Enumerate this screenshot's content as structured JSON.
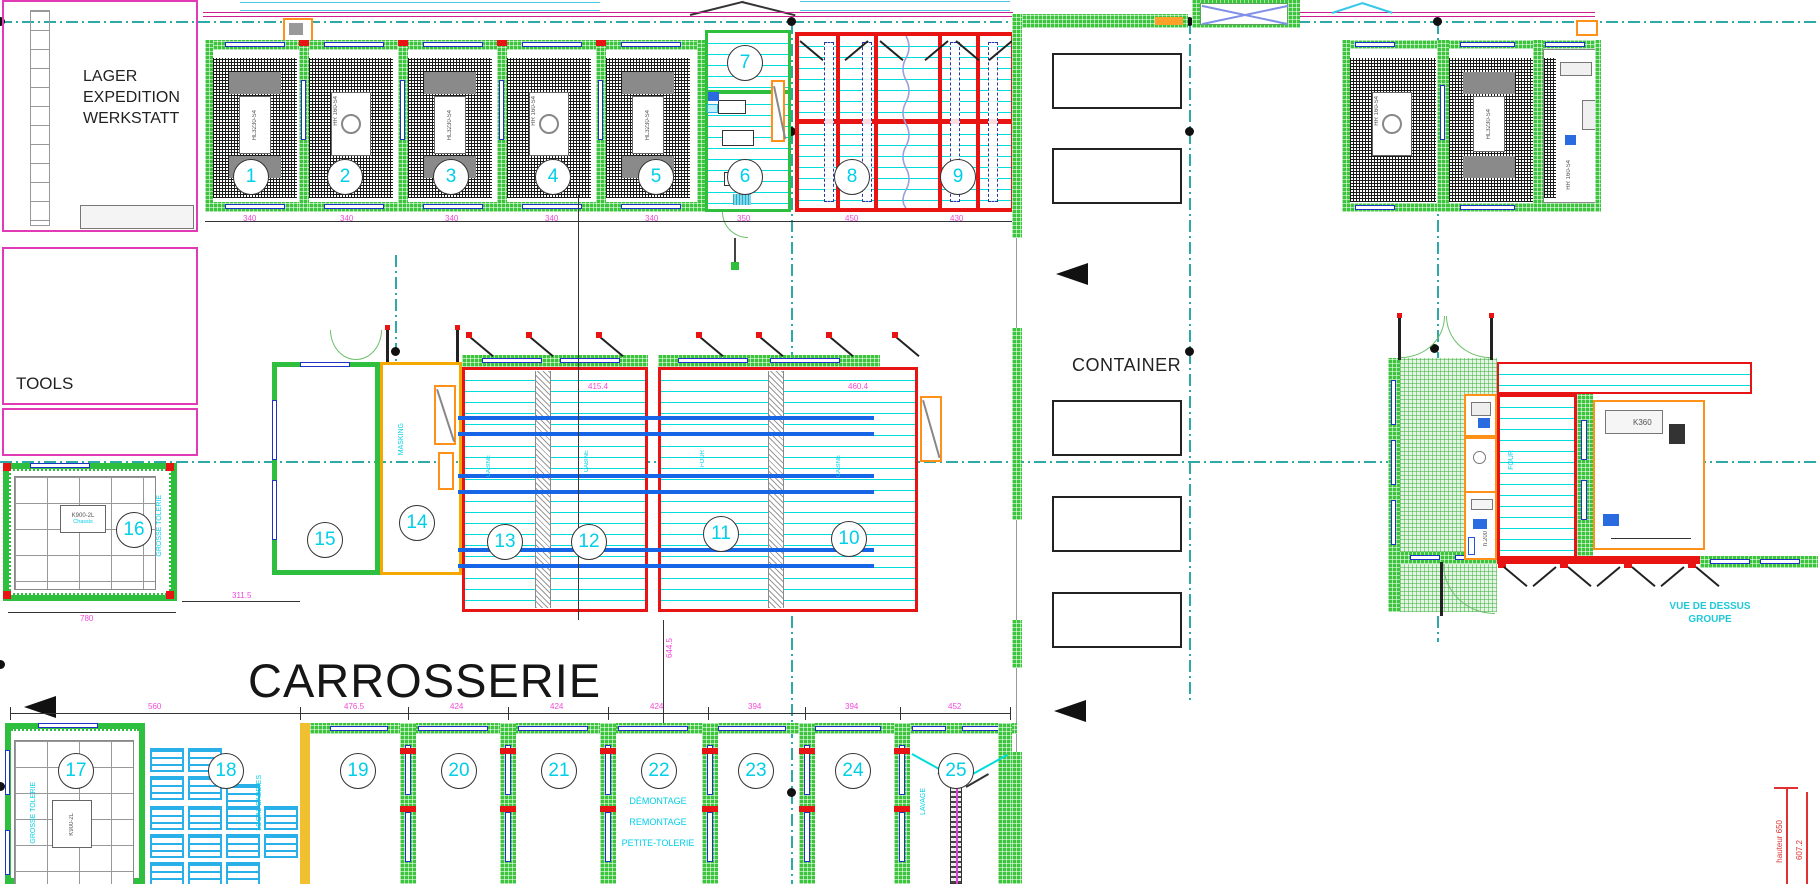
{
  "colors": {
    "green_wall": "#3cc43c",
    "red_wall": "#e81414",
    "cyan_line": "#00dcdc",
    "cyan_text": "#00cfe8",
    "magenta_dim": "#f049d8",
    "blue_rail": "#1565e6",
    "window_blue": "#1f32c8",
    "orange": "#ff9018",
    "grid_teal": "#2fa8a8"
  },
  "areas": {
    "lager": [
      "LAGER",
      "EXPEDITION",
      "WERKSTATT"
    ],
    "tools": "TOOLS",
    "carrosserie": "CARROSSERIE",
    "container": "CONTAINER"
  },
  "stations": [
    "1",
    "2",
    "3",
    "4",
    "5",
    "6",
    "7",
    "8",
    "9",
    "10",
    "11",
    "12",
    "13",
    "14",
    "15",
    "16",
    "17",
    "18",
    "19",
    "20",
    "21",
    "22",
    "23",
    "24",
    "25"
  ],
  "zone_labels": {
    "masking": "MASKING",
    "grosse_tolerie_16": "GROSSE TOLERIE",
    "grosse_tolerie_17": "GROSSE TOLERIE",
    "local_caddies": "LOCAL CADDIES",
    "demontage": "DÉMONTAGE",
    "remontage": "REMONTAGE",
    "petite_tolerie": "PETITE-TOLERIE",
    "lavage": "LAVAGE",
    "cabine_13": "CABINE",
    "cabine_12": "CABINE",
    "four_11": "FOUR",
    "cabine_10": "CABINE",
    "four_rs": "FOUR",
    "vue_line1": "VUE DE DESSUS",
    "vue_line2": "GROUPE"
  },
  "equipment": {
    "lift_a": "HL3230-S4",
    "lift_b": "HR 160-S4",
    "k900": "K900-2L",
    "chassis": "Chassis",
    "k360": "K360",
    "h200": "h.200"
  },
  "dimensions": {
    "top": [
      "340",
      "340",
      "340",
      "340",
      "340",
      "350",
      "450",
      "430"
    ],
    "bottom": [
      "560",
      "476.5",
      "424",
      "424",
      "424",
      "394",
      "394",
      "452"
    ],
    "bay16_width": "780",
    "bay16_right": "311.5",
    "mid_vertical": "644.5",
    "booth_a": "415.4",
    "booth_b": "460.4",
    "hauteur": "hauteur 650",
    "height2": "607.2"
  }
}
